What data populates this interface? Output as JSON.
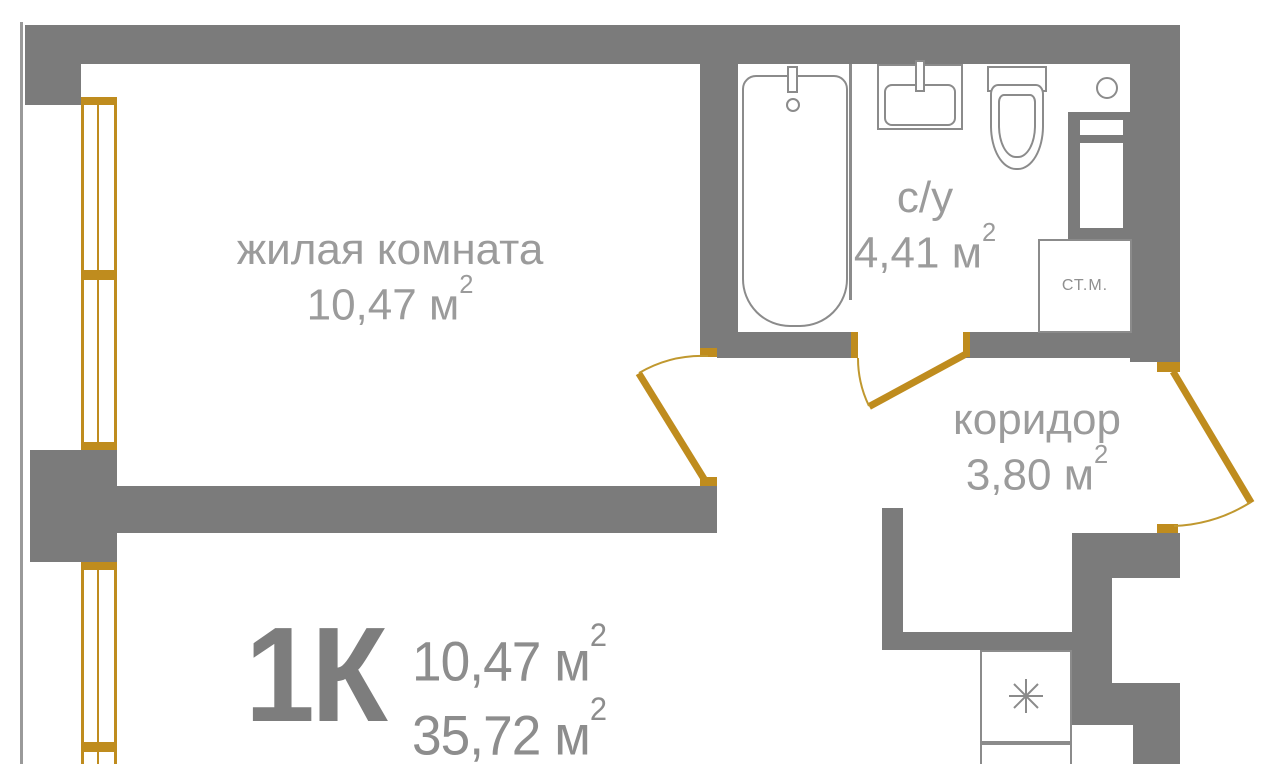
{
  "plan": {
    "units": {
      "base": "м",
      "sup": "2"
    },
    "rooms": {
      "living": {
        "name": "жилая комната",
        "area": "10,47"
      },
      "bathroom": {
        "name": "с/у",
        "area": "4,41"
      },
      "corridor": {
        "name": "коридор",
        "area": "3,80"
      }
    },
    "appliances": {
      "washing_machine": "СТ.М."
    },
    "summary": {
      "type": "1К",
      "living_area": "10,47",
      "total_area": "35,72"
    },
    "colors": {
      "wall": "#7b7b7b",
      "window_door_gold": "#bf8c1e",
      "fixture_outline": "#8b8b8b",
      "label_text": "#9b9b9b",
      "summary_text": "#7d7d7d"
    }
  }
}
